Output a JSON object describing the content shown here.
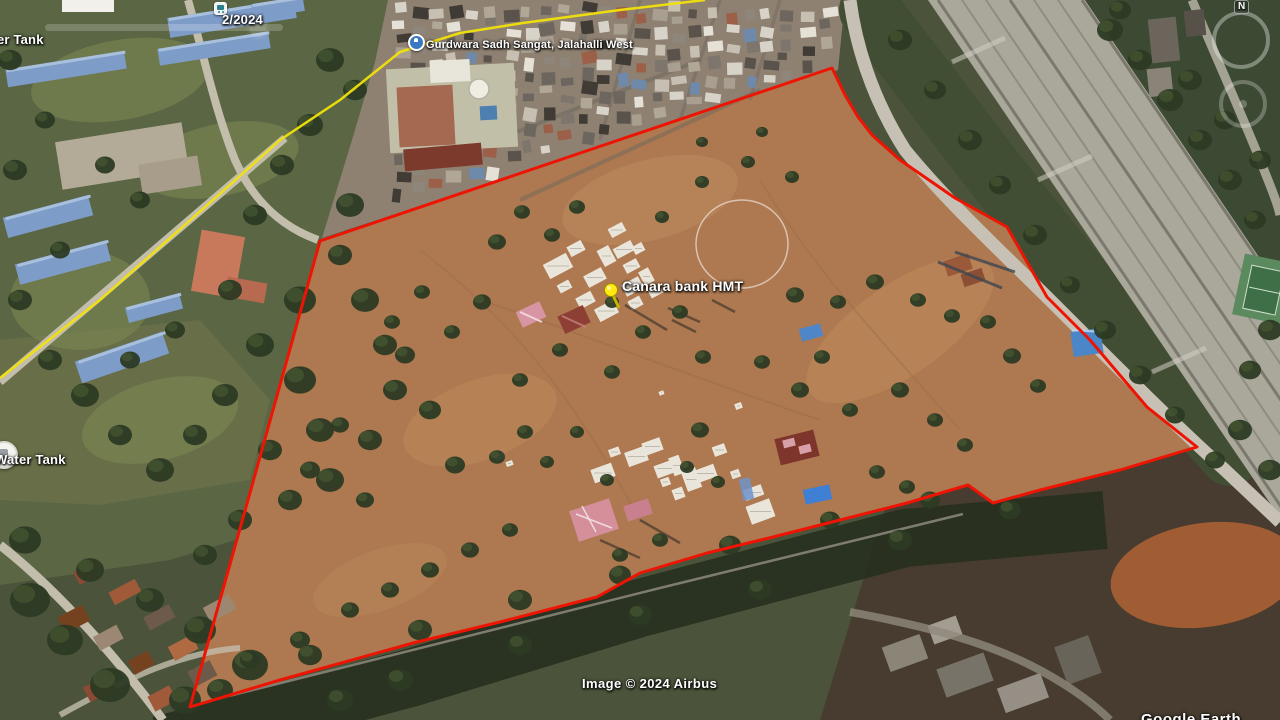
{
  "view": {
    "imagery_date": "2/2024",
    "compass_north": "N"
  },
  "labels": {
    "water_tank_top": "Water Tank",
    "water_tank_mid": "Water Tank",
    "gurdwara": "Gurdwara Sadh Sangat, Jalahalli West",
    "canara_pin": "Canara bank HMT"
  },
  "attribution": {
    "imagery": "Image © 2024 Airbus",
    "watermark": "Google Earth"
  },
  "overlay": {
    "boundary_color": "#ee1404",
    "path_color": "#f2e20a",
    "field_color": "#ae7950"
  }
}
